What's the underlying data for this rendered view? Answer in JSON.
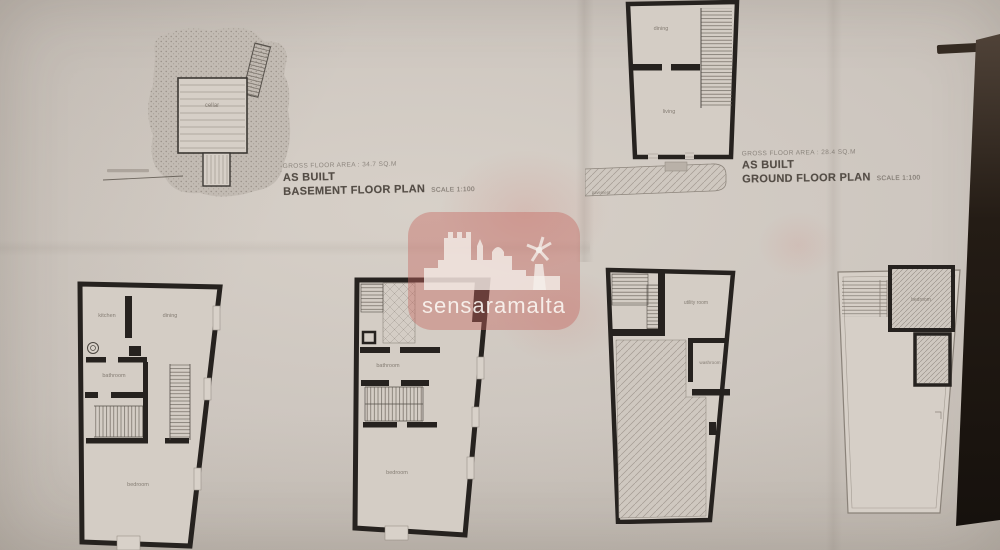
{
  "colors": {
    "paper": "#cdc6bf",
    "ink": "#26221f",
    "watermark_pink": "#c96f66"
  },
  "watermark": {
    "label": "sensaramalta"
  },
  "sheets": {
    "basement": {
      "area_note": "GROSS FLOOR AREA : 34.7 SQ.M",
      "as_built": "AS BUILT",
      "title": "BASEMENT FLOOR PLAN",
      "scale_note": "SCALE 1:100",
      "rooms": {
        "cellar": "cellar"
      }
    },
    "ground": {
      "area_note": "GROSS FLOOR AREA : 28.4 SQ.M",
      "as_built": "AS BUILT",
      "title": "GROUND FLOOR PLAN",
      "scale_note": "SCALE 1:100",
      "rooms": {
        "dining": "dining",
        "living": "living",
        "pavement": "pavement"
      }
    },
    "first_floor": {
      "rooms": {
        "kitchen": "kitchen",
        "dining": "dining",
        "bathroom": "bathroom",
        "bedroom": "bedroom"
      }
    },
    "second_floor": {
      "rooms": {
        "bathroom": "bathroom",
        "bedroom": "bedroom"
      }
    },
    "third_floor": {
      "rooms": {
        "utility": "utility room",
        "washroom": "washroom"
      }
    },
    "roof": {
      "rooms": {
        "bedroom": "bedroom"
      }
    }
  }
}
